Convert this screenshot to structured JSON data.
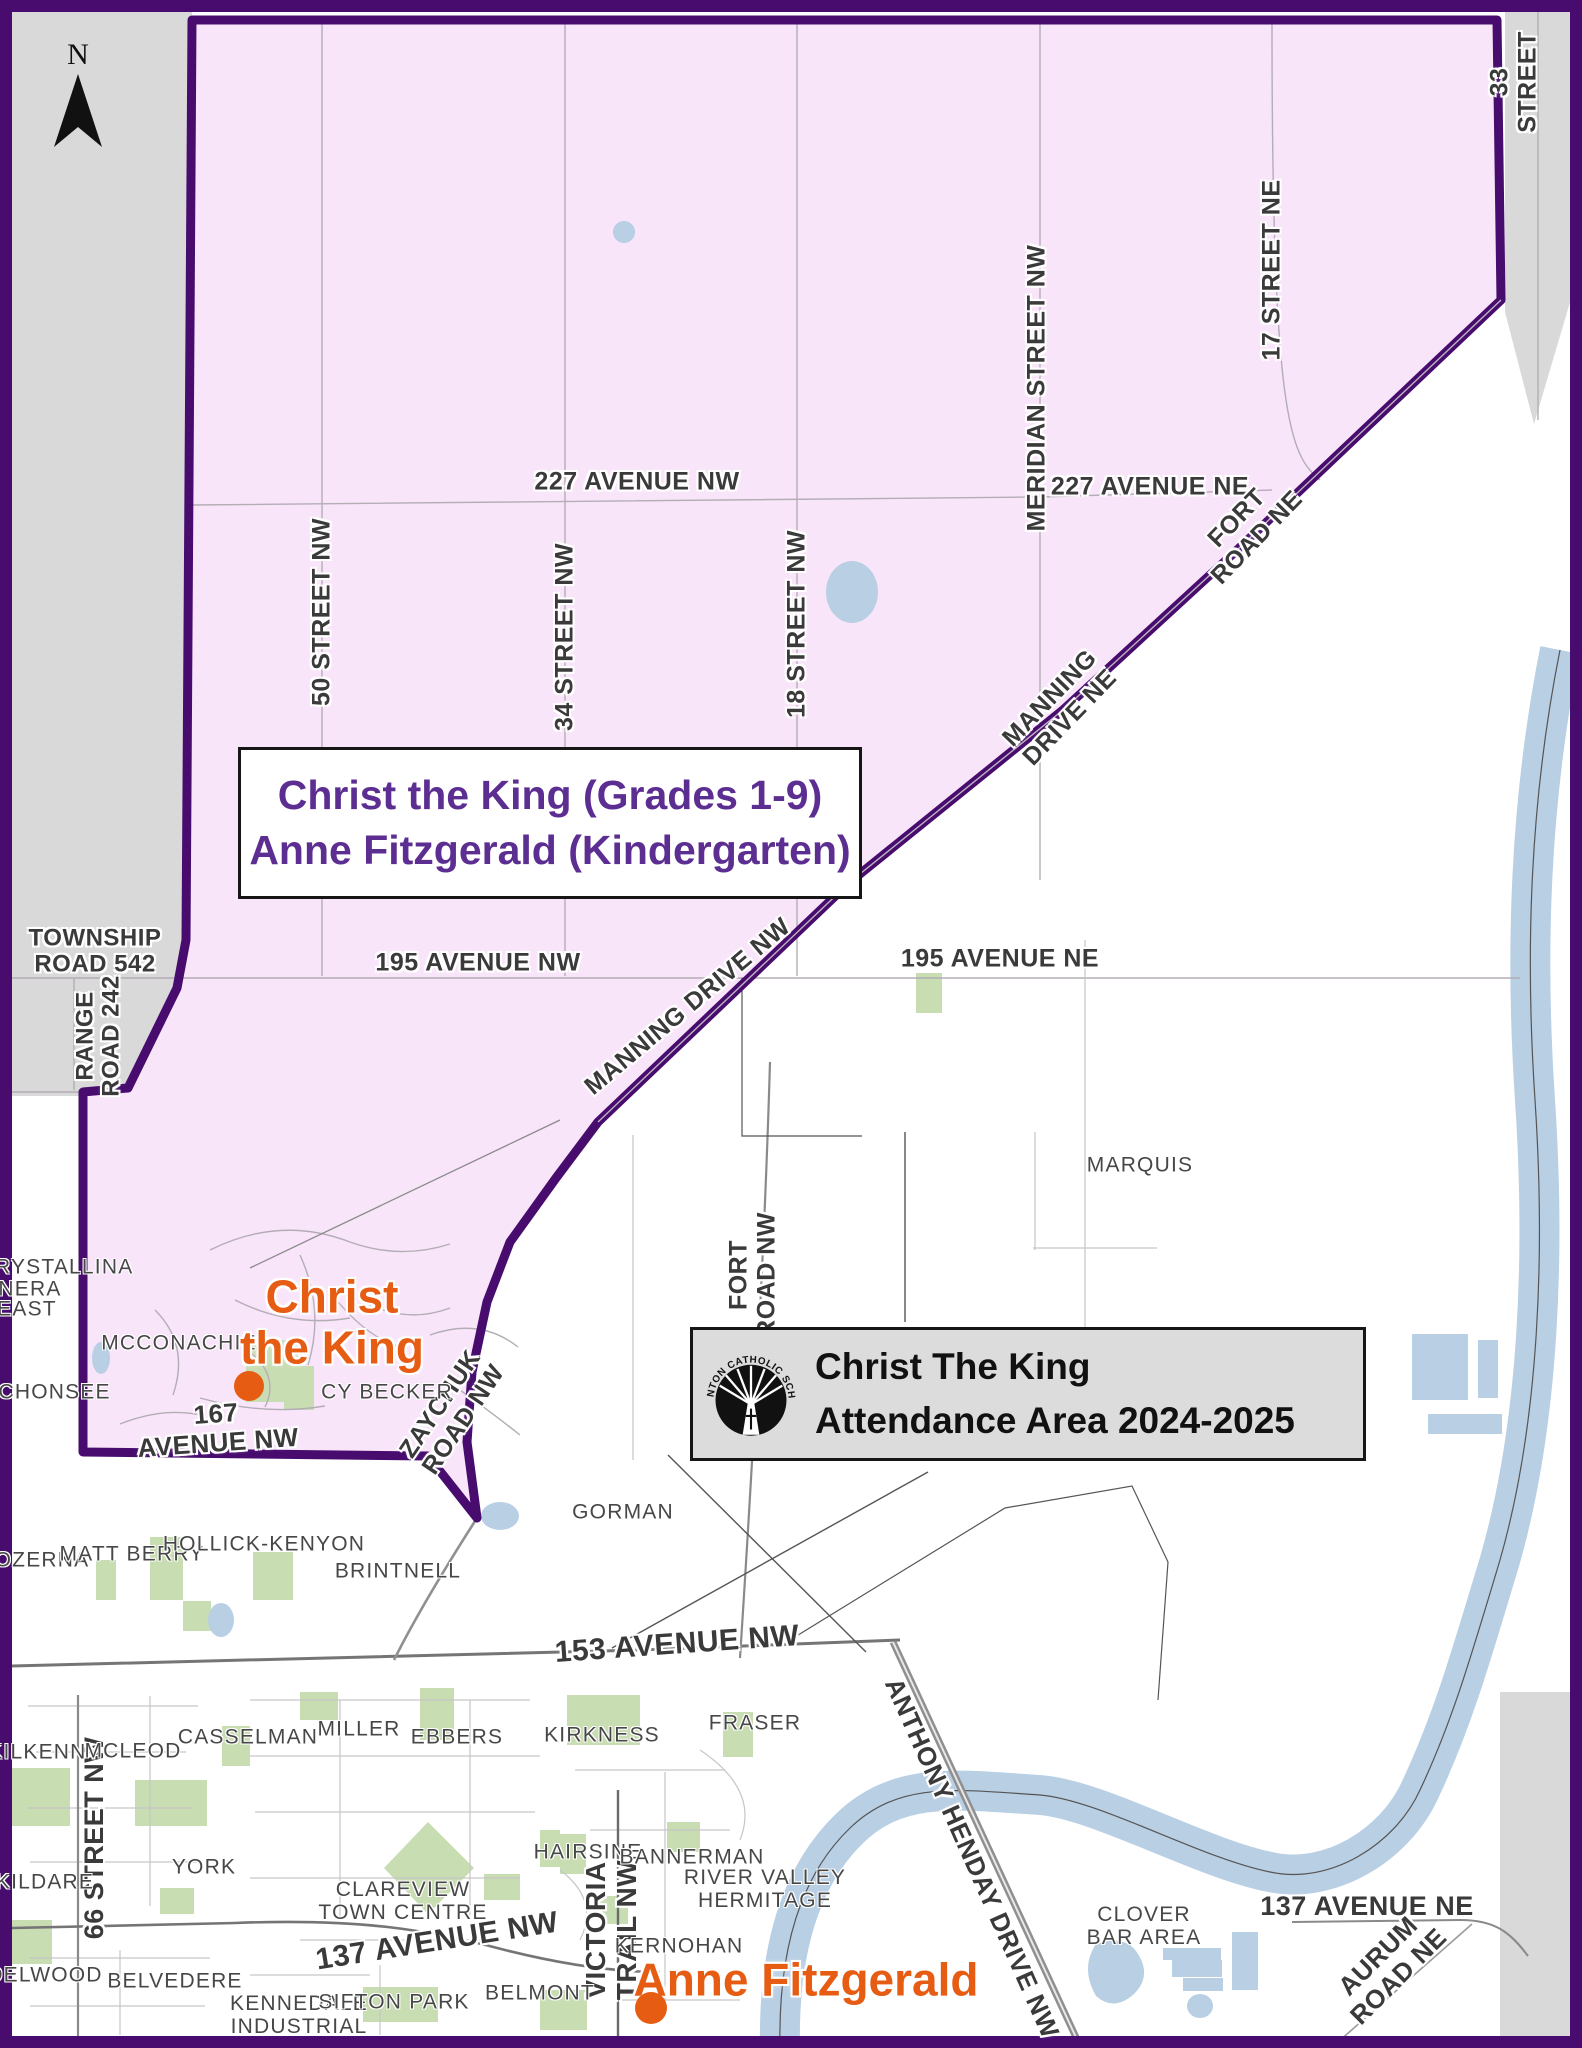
{
  "north_arrow": {
    "label": "N"
  },
  "region_label": {
    "line1": "Christ the King (Grades 1-9)",
    "line2": "Anne Fitzgerald (Kindergarten)"
  },
  "title_box": {
    "org_name": "EDMONTON CATHOLIC SCHOOLS",
    "line1": "Christ The King",
    "line2": "Attendance Area 2024-2025"
  },
  "schools": [
    {
      "name": "Christ the King",
      "label": "Christ\nthe King",
      "x": 332,
      "y": 1322,
      "size": 46,
      "dot_x": 249,
      "dot_y": 1386,
      "dot_r": 15
    },
    {
      "name": "Anne Fitzgerald",
      "label": "Anne Fitzgerald",
      "x": 806,
      "y": 1980,
      "size": 46,
      "dot_x": 651,
      "dot_y": 2008,
      "dot_r": 16
    }
  ],
  "street_labels": [
    {
      "text": "227 AVENUE NW",
      "x": 637,
      "y": 482,
      "rot": 0,
      "size": 25
    },
    {
      "text": "227 AVENUE NE",
      "x": 1150,
      "y": 487,
      "rot": 0,
      "size": 25
    },
    {
      "text": "50 STREET NW",
      "x": 322,
      "y": 612,
      "rot": -90,
      "size": 25
    },
    {
      "text": "34 STREET NW",
      "x": 565,
      "y": 637,
      "rot": -90,
      "size": 25
    },
    {
      "text": "18 STREET NW",
      "x": 797,
      "y": 624,
      "rot": -90,
      "size": 25
    },
    {
      "text": "MERIDIAN STREET NW",
      "x": 1037,
      "y": 388,
      "rot": -90,
      "size": 25
    },
    {
      "text": "17 STREET NE",
      "x": 1272,
      "y": 270,
      "rot": -90,
      "size": 25
    },
    {
      "text": "33 STREET",
      "x": 1514,
      "y": 82,
      "rot": -90,
      "size": 25
    },
    {
      "text": "FORT\nROAD NE",
      "x": 1247,
      "y": 528,
      "rot": -46,
      "size": 25
    },
    {
      "text": "MANNING\nDRIVE NE",
      "x": 1060,
      "y": 708,
      "rot": -46,
      "size": 25
    },
    {
      "text": "MANNING DRIVE NW",
      "x": 688,
      "y": 1007,
      "rot": -40,
      "size": 25
    },
    {
      "text": "TOWNSHIP\nROAD 542",
      "x": 95,
      "y": 952,
      "rot": 0,
      "size": 24
    },
    {
      "text": "RANGE\nROAD 242",
      "x": 99,
      "y": 1036,
      "rot": -90,
      "size": 24
    },
    {
      "text": "195 AVENUE NW",
      "x": 478,
      "y": 963,
      "rot": 0,
      "size": 25
    },
    {
      "text": "195 AVENUE NE",
      "x": 1000,
      "y": 959,
      "rot": 0,
      "size": 25
    },
    {
      "text": "FORT\nROAD NW",
      "x": 753,
      "y": 1275,
      "rot": -90,
      "size": 25
    },
    {
      "text": "167\nAVENUE NW",
      "x": 217,
      "y": 1428,
      "rot": -4,
      "size": 26
    },
    {
      "text": "ZAYCHUK\nROAD NW",
      "x": 452,
      "y": 1412,
      "rot": -56,
      "size": 25
    },
    {
      "text": "153 AVENUE NW",
      "x": 677,
      "y": 1644,
      "rot": -4,
      "size": 30
    },
    {
      "text": "137 AVENUE NW",
      "x": 437,
      "y": 1941,
      "rot": -9,
      "size": 30
    },
    {
      "text": "137 AVENUE NE",
      "x": 1367,
      "y": 1907,
      "rot": 0,
      "size": 27
    },
    {
      "text": "AURUM\nROAD NE",
      "x": 1388,
      "y": 1966,
      "rot": -45,
      "size": 26
    },
    {
      "text": "ANTHONY HENDAY DRIVE NW",
      "x": 972,
      "y": 1858,
      "rot": 66,
      "size": 26
    },
    {
      "text": "VICTORIA\nTRAIL NW",
      "x": 612,
      "y": 1930,
      "rot": -90,
      "size": 28
    },
    {
      "text": "66 STREET NW",
      "x": 95,
      "y": 1838,
      "rot": -90,
      "size": 27
    }
  ],
  "neighborhood_labels": [
    {
      "text": "CRYSTALLINA",
      "x": 56,
      "y": 1267
    },
    {
      "text": "NERA",
      "x": 30,
      "y": 1289
    },
    {
      "text": "EAST",
      "x": 27,
      "y": 1309
    },
    {
      "text": "SCHONSEE",
      "x": 47,
      "y": 1392
    },
    {
      "text": "MCCONACHIE",
      "x": 179,
      "y": 1343
    },
    {
      "text": "CY BECKER",
      "x": 387,
      "y": 1392
    },
    {
      "text": "MARQUIS",
      "x": 1140,
      "y": 1165
    },
    {
      "text": "GORMAN",
      "x": 623,
      "y": 1512
    },
    {
      "text": "OZERNA",
      "x": 42,
      "y": 1560
    },
    {
      "text": "MATT BERRY",
      "x": 132,
      "y": 1554
    },
    {
      "text": "HOLLICK-KENYON",
      "x": 264,
      "y": 1544
    },
    {
      "text": "BRINTNELL",
      "x": 398,
      "y": 1571
    },
    {
      "text": "KILKENNY",
      "x": 45,
      "y": 1752
    },
    {
      "text": "MCLEOD",
      "x": 133,
      "y": 1751
    },
    {
      "text": "CASSELMAN",
      "x": 248,
      "y": 1737
    },
    {
      "text": "MILLER",
      "x": 359,
      "y": 1729
    },
    {
      "text": "EBBERS",
      "x": 457,
      "y": 1737
    },
    {
      "text": "KIRKNESS",
      "x": 602,
      "y": 1735
    },
    {
      "text": "FRASER",
      "x": 755,
      "y": 1723
    },
    {
      "text": "YORK",
      "x": 204,
      "y": 1867
    },
    {
      "text": "KILDARE",
      "x": 45,
      "y": 1882
    },
    {
      "text": "CLAREVIEW\nTOWN CENTRE",
      "x": 403,
      "y": 1901
    },
    {
      "text": "HAIRSINE",
      "x": 588,
      "y": 1852
    },
    {
      "text": "BANNERMAN",
      "x": 692,
      "y": 1857
    },
    {
      "text": "RIVER VALLEY\nHERMITAGE",
      "x": 765,
      "y": 1889
    },
    {
      "text": "KERNOHAN",
      "x": 679,
      "y": 1946
    },
    {
      "text": "DELWOOD",
      "x": 45,
      "y": 1975
    },
    {
      "text": "BELVEDERE",
      "x": 175,
      "y": 1981
    },
    {
      "text": "KENNEDALE\nINDUSTRIAL",
      "x": 299,
      "y": 2015
    },
    {
      "text": "SIFTON PARK",
      "x": 394,
      "y": 2002
    },
    {
      "text": "BELMONT",
      "x": 540,
      "y": 1993
    },
    {
      "text": "CLOVER\nBAR AREA",
      "x": 1144,
      "y": 1926
    }
  ],
  "colors": {
    "boundary": "#470c6e",
    "area_fill": "#f9e5f9",
    "outside_city": "#d9d9d9",
    "water": "#b9cfe4",
    "park": "#c9ddb3",
    "school_marker": "#e65c13",
    "region_text": "#5c2e91"
  }
}
